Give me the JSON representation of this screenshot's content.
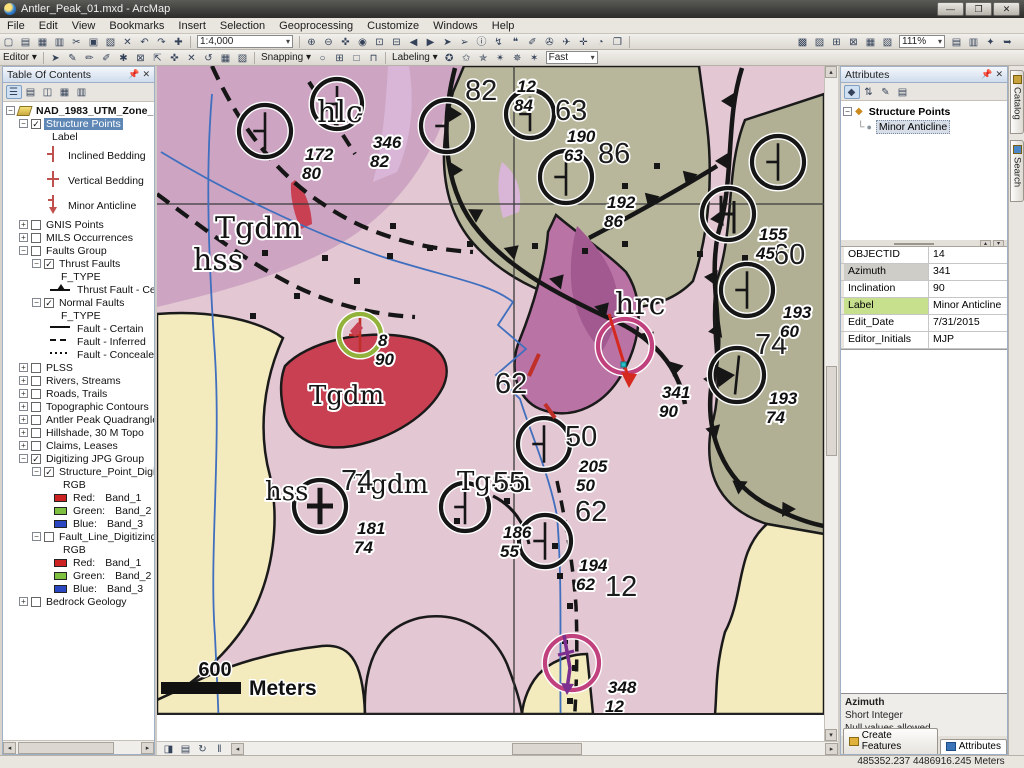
{
  "window": {
    "title": "Antler_Peak_01.mxd - ArcMap"
  },
  "menu": {
    "items": [
      "File",
      "Edit",
      "View",
      "Bookmarks",
      "Insert",
      "Selection",
      "Geoprocessing",
      "Customize",
      "Windows",
      "Help"
    ]
  },
  "toolbars": {
    "standard": {
      "scale": "1:4,000",
      "zoom_pct": "111%",
      "left_icons": [
        {
          "g": "▢",
          "n": "new-map"
        },
        {
          "g": "▤",
          "n": "open"
        },
        {
          "g": "▦",
          "n": "save"
        },
        {
          "g": "▥",
          "n": "print"
        },
        {
          "g": "✂",
          "n": "cut"
        },
        {
          "g": "▣",
          "n": "copy"
        },
        {
          "g": "▧",
          "n": "paste"
        },
        {
          "g": "✕",
          "n": "delete"
        },
        {
          "g": "↶",
          "n": "undo"
        },
        {
          "g": "↷",
          "n": "redo"
        },
        {
          "g": "✚",
          "n": "add-data"
        }
      ],
      "mid_icons": [
        {
          "g": "⊕",
          "n": "zoom-in"
        },
        {
          "g": "⊖",
          "n": "zoom-out"
        },
        {
          "g": "✜",
          "n": "pan-hand"
        },
        {
          "g": "◉",
          "n": "full-extent"
        },
        {
          "g": "⊡",
          "n": "fixed-zoom-in"
        },
        {
          "g": "⊟",
          "n": "fixed-zoom-out"
        },
        {
          "g": "◀",
          "n": "previous-extent"
        },
        {
          "g": "▶",
          "n": "next-extent"
        },
        {
          "g": "➤",
          "n": "select-features"
        },
        {
          "g": "➢",
          "n": "select-elements"
        },
        {
          "g": "ⓘ",
          "n": "identify"
        },
        {
          "g": "↯",
          "n": "hyperlink"
        },
        {
          "g": "❝",
          "n": "html-popup"
        },
        {
          "g": "✐",
          "n": "measure"
        },
        {
          "g": "✇",
          "n": "find"
        },
        {
          "g": "✈",
          "n": "find-route"
        },
        {
          "g": "✛",
          "n": "go-to-xy"
        },
        {
          "g": "◔",
          "n": "time-slider"
        },
        {
          "g": "❐",
          "n": "viewer-window"
        }
      ],
      "right_icons1": [
        {
          "g": "▩",
          "n": "catalog-window"
        },
        {
          "g": "▨",
          "n": "search-window"
        },
        {
          "g": "⊞",
          "n": "toolbox"
        },
        {
          "g": "⊠",
          "n": "model-builder"
        },
        {
          "g": "▦",
          "n": "python-window"
        },
        {
          "g": "▧",
          "n": "image-analysis"
        }
      ],
      "right_icons2": [
        {
          "g": "▤",
          "n": "raster-paint"
        },
        {
          "g": "▥",
          "n": "raster-cleanup"
        },
        {
          "g": "✦",
          "n": "lock-raster"
        },
        {
          "g": "➥",
          "n": "export-raster"
        }
      ]
    },
    "editor": {
      "label": "Editor",
      "icons": [
        {
          "g": "➤",
          "n": "edit-tool"
        },
        {
          "g": "✎",
          "n": "edit-annotation"
        },
        {
          "g": "✏",
          "n": "straight-segment"
        },
        {
          "g": "✐",
          "n": "endpoint-arc"
        },
        {
          "g": "✱",
          "n": "vertex-tool"
        },
        {
          "g": "⊠",
          "n": "trace"
        },
        {
          "g": "⇱",
          "n": "reshape"
        },
        {
          "g": "✜",
          "n": "move"
        },
        {
          "g": "✕",
          "n": "split"
        },
        {
          "g": "↺",
          "n": "rotate"
        },
        {
          "g": "▦",
          "n": "attributes-window"
        },
        {
          "g": "▧",
          "n": "sketch-properties"
        }
      ]
    },
    "snapping": {
      "label": "Snapping",
      "icons": [
        {
          "g": "○",
          "n": "point-snap"
        },
        {
          "g": "⊞",
          "n": "end-snap"
        },
        {
          "g": "□",
          "n": "vertex-snap"
        },
        {
          "g": "⊓",
          "n": "edge-snap"
        }
      ]
    },
    "labeling": {
      "label": "Labeling",
      "speed": "Fast",
      "icons": [
        {
          "g": "✪",
          "n": "label-manager"
        },
        {
          "g": "✩",
          "n": "label-priority"
        },
        {
          "g": "✯",
          "n": "label-weight"
        },
        {
          "g": "✴",
          "n": "lock-labels"
        },
        {
          "g": "✵",
          "n": "pause-labeling"
        },
        {
          "g": "✶",
          "n": "view-unplaced"
        }
      ]
    }
  },
  "toc": {
    "title": "Table Of Contents",
    "tool_icons": [
      {
        "g": "☰",
        "n": "list-by-drawing-order",
        "p": true
      },
      {
        "g": "▤",
        "n": "list-by-source"
      },
      {
        "g": "◫",
        "n": "list-by-visibility"
      },
      {
        "g": "▦",
        "n": "list-by-selection"
      },
      {
        "g": "▥",
        "n": "toc-options"
      }
    ],
    "tree": [
      {
        "lvl": 0,
        "exp": "m",
        "icon": "frame",
        "label": "NAD_1983_UTM_Zone_11N",
        "bold": true
      },
      {
        "lvl": 1,
        "exp": "m",
        "chk": true,
        "label": "Structure Points",
        "sel": true
      },
      {
        "lvl": 2,
        "label": "Label",
        "pad": 18
      },
      {
        "lvl": 2,
        "sym": "inclined",
        "label": "Inclined Bedding",
        "tall": true,
        "pad": 12
      },
      {
        "lvl": 2,
        "sym": "vertical",
        "label": "Vertical Bedding",
        "tall": true,
        "pad": 12
      },
      {
        "lvl": 2,
        "sym": "anticline",
        "label": "Minor Anticline",
        "tall": true,
        "pad": 12
      },
      {
        "lvl": 1,
        "exp": "p",
        "chk": false,
        "label": "GNIS Points"
      },
      {
        "lvl": 1,
        "exp": "p",
        "chk": false,
        "label": "MILS Occurrences"
      },
      {
        "lvl": 1,
        "exp": "m",
        "chk": false,
        "label": "Faults Group"
      },
      {
        "lvl": 2,
        "exp": "m",
        "chk": true,
        "label": "Thrust Faults"
      },
      {
        "lvl": 3,
        "label": "F_TYPE",
        "pad": 14
      },
      {
        "lvl": 3,
        "sym": "thrust",
        "label": "Thrust Fault - Certain",
        "pad": 4
      },
      {
        "lvl": 2,
        "exp": "m",
        "chk": true,
        "label": "Normal Faults"
      },
      {
        "lvl": 3,
        "label": "F_TYPE",
        "pad": 14
      },
      {
        "lvl": 3,
        "sym": "solid",
        "label": "Fault - Certain",
        "pad": 4
      },
      {
        "lvl": 3,
        "sym": "dashed",
        "label": "Fault - Inferred",
        "pad": 4
      },
      {
        "lvl": 3,
        "sym": "dotted",
        "label": "Fault - Concealed",
        "pad": 4
      },
      {
        "lvl": 1,
        "exp": "p",
        "chk": false,
        "label": "PLSS"
      },
      {
        "lvl": 1,
        "exp": "p",
        "chk": false,
        "label": "Rivers, Streams"
      },
      {
        "lvl": 1,
        "exp": "p",
        "chk": false,
        "label": "Roads, Trails"
      },
      {
        "lvl": 1,
        "exp": "p",
        "chk": false,
        "label": "Topographic Contours"
      },
      {
        "lvl": 1,
        "exp": "p",
        "chk": false,
        "label": "Antler Peak Quadrangle"
      },
      {
        "lvl": 1,
        "exp": "p",
        "chk": false,
        "label": "Hillshade, 30 M Topo"
      },
      {
        "lvl": 1,
        "exp": "p",
        "chk": false,
        "label": "Claims, Leases"
      },
      {
        "lvl": 1,
        "exp": "m",
        "chk": true,
        "label": "Digitizing JPG Group"
      },
      {
        "lvl": 2,
        "exp": "m",
        "chk": true,
        "label": "Structure_Point_Digitizing.jpg"
      },
      {
        "lvl": 3,
        "label": "RGB",
        "pad": 16
      },
      {
        "lvl": 3,
        "sym": "sw-red",
        "label": "Red:",
        "value": "Band_1",
        "pad": 8
      },
      {
        "lvl": 3,
        "sym": "sw-green",
        "label": "Green:",
        "value": "Band_2",
        "pad": 8
      },
      {
        "lvl": 3,
        "sym": "sw-blue",
        "label": "Blue:",
        "value": "Band_3",
        "pad": 8
      },
      {
        "lvl": 2,
        "exp": "m",
        "chk": false,
        "label": "Fault_Line_Digitizing.jpg"
      },
      {
        "lvl": 3,
        "label": "RGB",
        "pad": 16
      },
      {
        "lvl": 3,
        "sym": "sw-red",
        "label": "Red:",
        "value": "Band_1",
        "pad": 8
      },
      {
        "lvl": 3,
        "sym": "sw-green",
        "label": "Green:",
        "value": "Band_2",
        "pad": 8
      },
      {
        "lvl": 3,
        "sym": "sw-blue",
        "label": "Blue:",
        "value": "Band_3",
        "pad": 8
      },
      {
        "lvl": 1,
        "exp": "p",
        "chk": false,
        "label": "Bedrock Geology"
      }
    ]
  },
  "map": {
    "scalebar": {
      "value": "600",
      "unit": "Meters"
    },
    "units": [
      {
        "t": "hlc",
        "x": 160,
        "y": 56,
        "s": 30
      },
      {
        "t": "Tgdm",
        "x": 58,
        "y": 172,
        "s": 30
      },
      {
        "t": "hss",
        "x": 36,
        "y": 204,
        "s": 30
      },
      {
        "t": "hrc",
        "x": 458,
        "y": 248,
        "s": 30
      },
      {
        "t": "Tgdm",
        "x": 152,
        "y": 338,
        "s": 26
      },
      {
        "t": "hss",
        "x": 108,
        "y": 434,
        "s": 26
      },
      {
        "t": "Tgdm",
        "x": 196,
        "y": 427,
        "s": 26
      },
      {
        "t": "Tgam",
        "x": 300,
        "y": 424,
        "s": 26
      }
    ],
    "bignums": [
      {
        "t": "82",
        "x": 308,
        "y": 34
      },
      {
        "t": "63",
        "x": 398,
        "y": 54
      },
      {
        "t": "86",
        "x": 441,
        "y": 97
      },
      {
        "t": "60",
        "x": 616,
        "y": 198
      },
      {
        "t": "74",
        "x": 598,
        "y": 288
      },
      {
        "t": "62",
        "x": 338,
        "y": 327
      },
      {
        "t": "50",
        "x": 408,
        "y": 380
      },
      {
        "t": "55",
        "x": 336,
        "y": 426
      },
      {
        "t": "62",
        "x": 418,
        "y": 455
      },
      {
        "t": "12",
        "x": 448,
        "y": 530
      },
      {
        "t": "74",
        "x": 184,
        "y": 424
      }
    ],
    "dips": [
      {
        "a": "172",
        "b": "80",
        "x": 148,
        "y": 94
      },
      {
        "a": "346",
        "b": "82",
        "x": 216,
        "y": 82
      },
      {
        "a": "12",
        "b": "84",
        "x": 360,
        "y": 26
      },
      {
        "a": "190",
        "b": "63",
        "x": 410,
        "y": 76
      },
      {
        "a": "192",
        "b": "86",
        "x": 450,
        "y": 142
      },
      {
        "a": "155",
        "b": "45",
        "x": 602,
        "y": 174
      },
      {
        "a": "193",
        "b": "60",
        "x": 626,
        "y": 252
      },
      {
        "a": "193",
        "b": "74",
        "x": 612,
        "y": 338
      },
      {
        "a": "341",
        "b": "90",
        "x": 505,
        "y": 332
      },
      {
        "a": "205",
        "b": "50",
        "x": 422,
        "y": 406
      },
      {
        "a": "8",
        "b": "90",
        "x": 221,
        "y": 280
      },
      {
        "a": "181",
        "b": "74",
        "x": 200,
        "y": 468
      },
      {
        "a": "186",
        "b": "55",
        "x": 346,
        "y": 472
      },
      {
        "a": "194",
        "b": "62",
        "x": 422,
        "y": 505
      },
      {
        "a": "348",
        "b": "12",
        "x": 451,
        "y": 627
      }
    ],
    "circles": [
      {
        "x": 108,
        "y": 65,
        "r": 26,
        "ring": "black",
        "sym": "strike"
      },
      {
        "x": 180,
        "y": 38,
        "r": 25,
        "ring": "black",
        "sym": "strike"
      },
      {
        "x": 290,
        "y": 60,
        "r": 26,
        "ring": "black",
        "sym": "strike"
      },
      {
        "x": 373,
        "y": 48,
        "r": 24,
        "ring": "black",
        "sym": "strike"
      },
      {
        "x": 409,
        "y": 111,
        "r": 26,
        "ring": "black",
        "sym": "strike"
      },
      {
        "x": 621,
        "y": 96,
        "r": 26,
        "ring": "black",
        "sym": "strike"
      },
      {
        "x": 571,
        "y": 148,
        "r": 26,
        "ring": "black",
        "sym": "hsym"
      },
      {
        "x": 590,
        "y": 224,
        "r": 26,
        "ring": "black",
        "sym": "strike"
      },
      {
        "x": 580,
        "y": 309,
        "r": 27,
        "ring": "black",
        "sym": "tri"
      },
      {
        "x": 203,
        "y": 269,
        "r": 21,
        "ring": "green",
        "sym": "redtick"
      },
      {
        "x": 468,
        "y": 280,
        "r": 27,
        "ring": "magenta",
        "sym": "arrow"
      },
      {
        "x": 387,
        "y": 378,
        "r": 26,
        "ring": "black",
        "sym": "strike"
      },
      {
        "x": 163,
        "y": 440,
        "r": 26,
        "ring": "black",
        "sym": "cross"
      },
      {
        "x": 308,
        "y": 441,
        "r": 24,
        "ring": "black",
        "sym": "strike"
      },
      {
        "x": 388,
        "y": 475,
        "r": 26,
        "ring": "black",
        "sym": "strike"
      },
      {
        "x": 415,
        "y": 597,
        "r": 27,
        "ring": "magenta",
        "sym": "purple"
      }
    ],
    "squares": [
      [
        108,
        187
      ],
      [
        168,
        192
      ],
      [
        233,
        190
      ],
      [
        273,
        182
      ],
      [
        313,
        178
      ],
      [
        378,
        180
      ],
      [
        428,
        185
      ],
      [
        468,
        178
      ],
      [
        543,
        188
      ],
      [
        588,
        192
      ],
      [
        96,
        250
      ],
      [
        140,
        230
      ],
      [
        350,
        435
      ],
      [
        300,
        455
      ],
      [
        398,
        480
      ],
      [
        403,
        510
      ],
      [
        413,
        540
      ],
      [
        408,
        575
      ],
      [
        418,
        602
      ],
      [
        413,
        635
      ],
      [
        468,
        120
      ],
      [
        500,
        100
      ],
      [
        236,
        160
      ],
      [
        200,
        215
      ]
    ]
  },
  "attributes": {
    "title": "Attributes",
    "tool_icons": [
      {
        "g": "◆",
        "n": "identify-style",
        "p": true
      },
      {
        "g": "⇅",
        "n": "sort-fields"
      },
      {
        "g": "✎",
        "n": "field-options"
      },
      {
        "g": "▤",
        "n": "layout-options"
      }
    ],
    "tree": {
      "parent": "Structure Points",
      "child": "Minor Anticline"
    },
    "table": {
      "rows": [
        {
          "f": "OBJECTID",
          "v": "14",
          "hl": ""
        },
        {
          "f": "Azimuth",
          "v": "341",
          "hl": "grey"
        },
        {
          "f": "Inclination",
          "v": "90",
          "hl": ""
        },
        {
          "f": "Label",
          "v": "Minor Anticline",
          "hl": "green"
        },
        {
          "f": "Edit_Date",
          "v": "7/31/2015",
          "hl": ""
        },
        {
          "f": "Editor_Initials",
          "v": "MJP",
          "hl": ""
        }
      ]
    },
    "field_info": {
      "name": "Azimuth",
      "type": "Short Integer",
      "note": "Null values allowed"
    },
    "tabs": [
      {
        "label": "Create Features"
      },
      {
        "label": "Attributes"
      }
    ]
  },
  "side_tabs": [
    {
      "label": "Catalog"
    },
    {
      "label": "Search"
    }
  ],
  "status": {
    "coords": "485352.237  4486916.245 Meters"
  }
}
